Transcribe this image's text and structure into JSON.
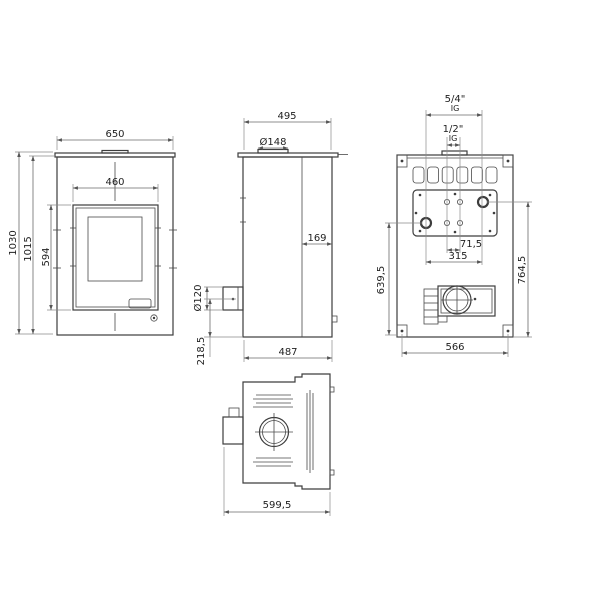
{
  "views": {
    "front": {
      "width": "650",
      "door_width": "460",
      "total_height": "1030",
      "body_height": "1015",
      "door_height": "594"
    },
    "side": {
      "top_depth": "495",
      "flue_diameter": "Ø148",
      "front_section_depth": "169",
      "rear_flue_diameter": "Ø120",
      "rear_flue_height": "218,5",
      "base_depth": "487"
    },
    "back": {
      "large_fitting": "5/4\"",
      "large_fitting_thread": "IG",
      "small_fitting": "1/2\"",
      "small_fitting_thread": "IG",
      "small_fitting_spacing": "71,5",
      "large_fitting_spacing": "315",
      "left_fitting_height": "639,5",
      "right_fitting_height": "764,5",
      "base_width": "566"
    },
    "top": {
      "overall_depth": "599,5"
    }
  }
}
